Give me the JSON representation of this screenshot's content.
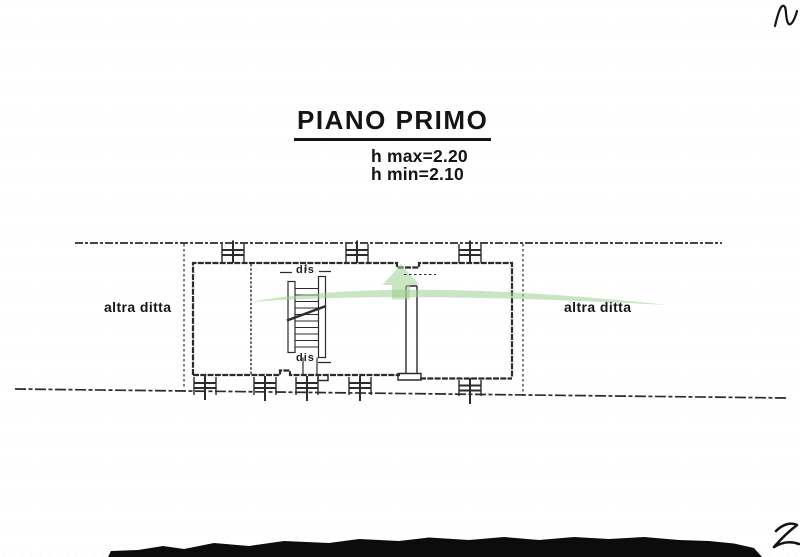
{
  "document": {
    "title": "PIANO PRIMO",
    "height_max": "h max=2.20",
    "height_min": "h min=2.10"
  },
  "plan": {
    "left_neighbor_label": "altra ditta",
    "right_neighbor_label": "altra ditta",
    "stair_label_top": "dis",
    "stair_label_bottom": "dis"
  },
  "icons": {
    "watermark": "green-arc-and-up-arrow-watermark",
    "staircase": "staircase-symbol",
    "windows": "window-in-wall-symbol"
  },
  "colors": {
    "paper": "#ffffff",
    "ink": "#141414",
    "line": "#2b2b2b",
    "wm": "#9ccf92"
  }
}
